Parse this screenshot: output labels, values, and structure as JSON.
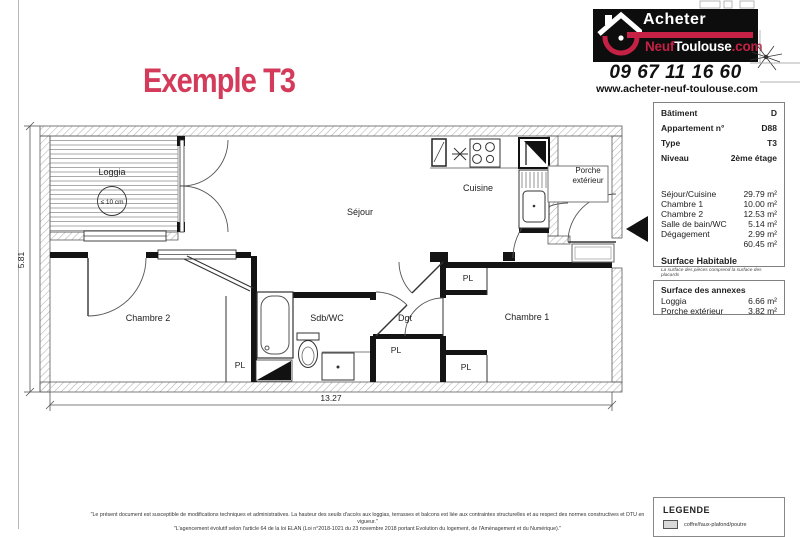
{
  "page": {
    "accent": "#d43a5a"
  },
  "header": {
    "title": "Exemple T3"
  },
  "logo": {
    "brand_top": "Acheter",
    "brand_red": "Neuf",
    "brand_white": "Toulouse",
    "brand_dotcom": ".com",
    "phone": "09 67 11 16 60",
    "website": "www.acheter-neuf-toulouse.com"
  },
  "info": {
    "rows": [
      {
        "label": "Bâtiment",
        "value": "D"
      },
      {
        "label": "Appartement n°",
        "value": "D88"
      },
      {
        "label": "Type",
        "value": "T3"
      },
      {
        "label": "Niveau",
        "value": "2ème étage"
      }
    ],
    "areas": [
      {
        "label": "Séjour/Cuisine",
        "value": "29.79 m²"
      },
      {
        "label": "Chambre 1",
        "value": "10.00 m²"
      },
      {
        "label": "Chambre 2",
        "value": "12.53 m²"
      },
      {
        "label": "Salle de bain/WC",
        "value": "5.14 m²"
      },
      {
        "label": "Dégagement",
        "value": "2.99 m²"
      },
      {
        "label": "",
        "value": "60.45 m²"
      }
    ],
    "surface_title": "Surface Habitable",
    "surface_note": "La surface des pièces comprend la surface des placards",
    "annexes_title": "Surface des annexes",
    "annexes": [
      {
        "label": "Loggia",
        "value": "6.66 m²"
      },
      {
        "label": "Porche extérieur",
        "value": "3.82 m²"
      }
    ]
  },
  "plan": {
    "rooms": {
      "loggia": "Loggia",
      "loggia_note": "≤ 10 cm",
      "sejour": "Séjour",
      "cuisine": "Cuisine",
      "porche1": "Porche",
      "porche2": "extérieur",
      "chambre1": "Chambre 1",
      "chambre2": "Chambre 2",
      "sdb": "Sdb/WC",
      "dgt": "Dgt",
      "pl": "PL"
    },
    "dims": {
      "width": "13.27",
      "height": "5.81"
    }
  },
  "legend": {
    "title": "LEGENDE",
    "items": [
      {
        "label": "coffre/faux-plafond/poutre",
        "swatch": "#d8d8d8"
      }
    ]
  },
  "footer": {
    "line1": "\"Le présent document est susceptible de modifications techniques et administratives. La hauteur des seuils d'accès aux loggias, terrasses et balcons est liée aux contraintes structurelles et au respect des normes constructives et DTU en vigueur.\"",
    "line2": "\"L'agencement évolutif selon l'article 64 de la loi ELAN (Loi n°2018-1021 du 23 novembre 2018 portant Evolution du logement, de l'Aménagement et du Numérique).\""
  }
}
